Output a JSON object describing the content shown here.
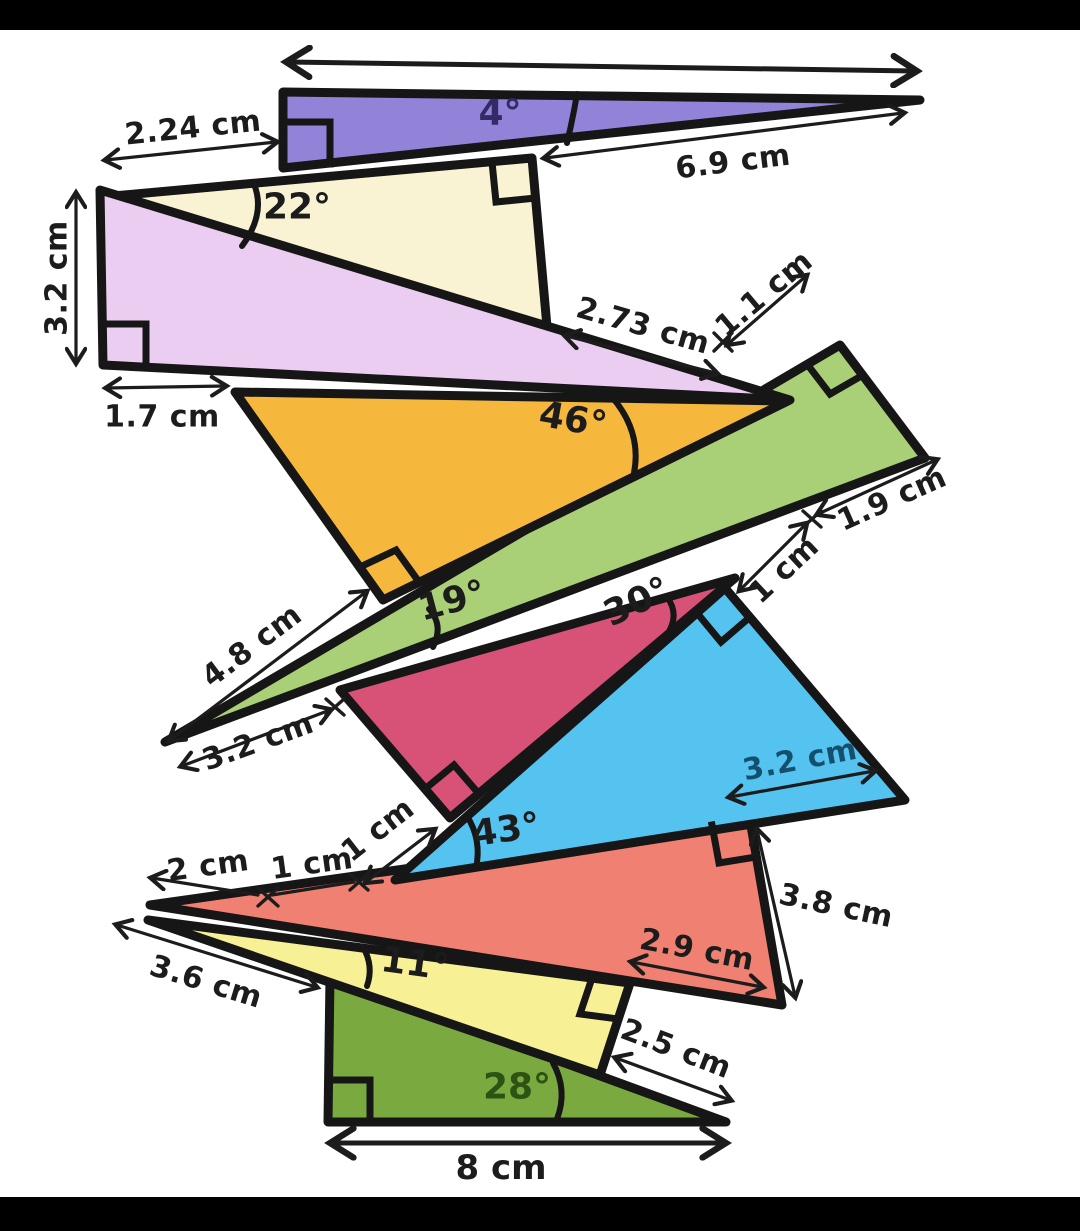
{
  "scene": {
    "description": "Worksheet diagram of ten stacked right-angled triangles with labelled angles and side lengths",
    "background": "#ffffff",
    "letterbox_color": "#000000",
    "stroke_color": "#161616"
  },
  "triangles": [
    {
      "name": "purple",
      "fill": "#9283d8",
      "angle_ref": "4°"
    },
    {
      "name": "cream",
      "fill": "#faf3d3",
      "angle_ref": "22°"
    },
    {
      "name": "lavender",
      "fill": "#eccdf2",
      "angle_ref": ""
    },
    {
      "name": "orange",
      "fill": "#f5b83d",
      "angle_ref": "46°"
    },
    {
      "name": "light-green",
      "fill": "#a9d077",
      "angle_ref": "19°"
    },
    {
      "name": "magenta",
      "fill": "#d85277",
      "angle_ref": "30°"
    },
    {
      "name": "blue",
      "fill": "#55c3f0",
      "angle_ref": "43°"
    },
    {
      "name": "salmon",
      "fill": "#f08172",
      "angle_ref": ""
    },
    {
      "name": "yellow",
      "fill": "#f8f095",
      "angle_ref": "11°"
    },
    {
      "name": "dark-green",
      "fill": "#7aa93f",
      "angle_ref": "28°"
    }
  ],
  "labels": {
    "purple_angle": "4°",
    "len_2_24": "2.24 cm",
    "len_6_9": "6.9 cm",
    "cream_angle": "22°",
    "len_2_73": "2.73 cm",
    "len_1_1": "1.1 cm",
    "len_3_2_left": "3.2 cm",
    "len_1_7": "1.7 cm",
    "orange_angle": "46°",
    "green_angle": "19°",
    "len_4_8": "4.8 cm",
    "len_3_2_green": "3.2 cm",
    "magenta_angle": "30°",
    "len_1_green": "1 cm",
    "len_1_9": "1.9 cm",
    "blue_angle": "43°",
    "len_3_2_blue": "3.2 cm",
    "len_3_8": "3.8 cm",
    "len_2_9": "2.9 cm",
    "len_2": "2 cm",
    "len_1_a": "1 cm",
    "len_1_b": "1 cm",
    "len_3_6": "3.6 cm",
    "yellow_angle": "11°",
    "len_2_5": "2.5 cm",
    "dgreen_angle": "28°",
    "len_8": "8 cm"
  },
  "label_colors": {
    "default": "#1c1c1c",
    "purple_angle_text": "#342a66",
    "blue_length_text": "#14506e",
    "dgreen_angle_text": "#2c5214"
  }
}
